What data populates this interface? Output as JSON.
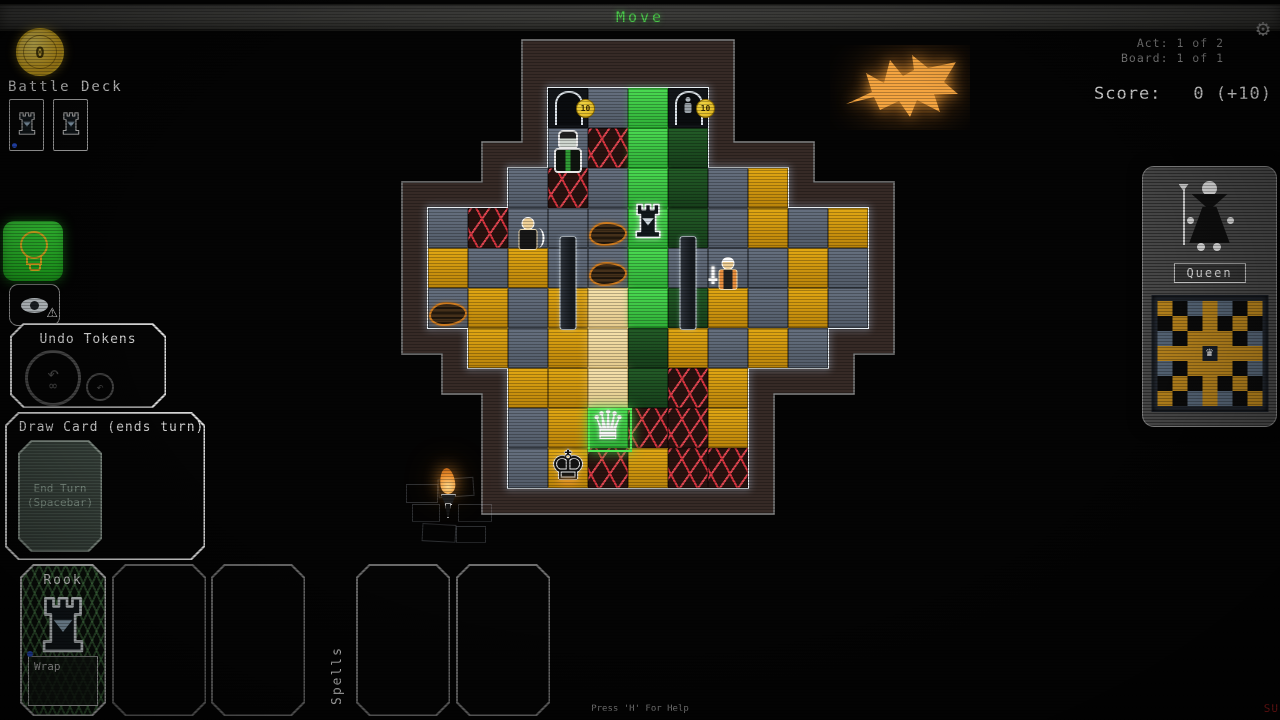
{
  "top_bar": {
    "title": "Move"
  },
  "top_right": {
    "act": "Act: 1 of 2",
    "board": "Board: 1 of 1",
    "score_label": "Score:",
    "score_value": "0 (+10)"
  },
  "left_hud": {
    "coin_value": "0",
    "battle_deck_label": "Battle Deck",
    "deck_card_count": 2
  },
  "icons": {
    "settings": "gear-icon",
    "hint": "lightbulb-icon",
    "preview": "eye-warning-icon",
    "undo_big": "undo-infinity-icon",
    "undo_small": "undo-arrow-icon",
    "coin": "gold-coin-icon",
    "undo_arrow_glyph": "↶",
    "infinity_glyph": "∞",
    "warning_glyph": "⚠",
    "gear_glyph": "⚙"
  },
  "undo_panel": {
    "title": "Undo Tokens"
  },
  "draw_panel": {
    "title": "Draw Card (ends turn)",
    "line1": "End Turn",
    "line2": "(Spacebar)"
  },
  "hand": {
    "cards": [
      {
        "name": "Rook",
        "ability": "Wrap",
        "icon": "rook-tower-icon",
        "marker_color": "#2b54d8"
      }
    ],
    "empty_slots": 2
  },
  "spells": {
    "label": "Spells",
    "empty_slots": 2
  },
  "piece_panel": {
    "name": "Queen",
    "figure": "queen-character-illustration",
    "mini_board": {
      "pattern": [
        "GKBGBKG",
        "KGKGKGK",
        "BKGGGKB",
        "GGGQGGG",
        "BKGGGKB",
        "KGKGKGK",
        "GKBGBKG"
      ],
      "colors": {
        "G": "#c28b1e",
        "B": "#5b6b7d",
        "K": "#0c0c0c",
        "Q": "#1c222b"
      },
      "center_piece": "queen"
    }
  },
  "board": {
    "door_badge": "10",
    "rows": [
      {
        "r": 0,
        "start": 3,
        "cells": "DGED"
      },
      {
        "r": 1,
        "start": 3,
        "cells": "GLEN"
      },
      {
        "r": 2,
        "start": 2,
        "cells": "GLGENGO"
      },
      {
        "r": 3,
        "start": 0,
        "cells": "GLGGGENGOGO"
      },
      {
        "r": 4,
        "start": 0,
        "cells": "OGOGGEGGGOG"
      },
      {
        "r": 5,
        "start": 0,
        "cells": "GOGOCENOGOG"
      },
      {
        "r": 6,
        "start": 1,
        "cells": "OGOCNOGOG"
      },
      {
        "r": 7,
        "start": 2,
        "cells": "OOCNLO"
      },
      {
        "r": 8,
        "start": 2,
        "cells": "GOELLO"
      },
      {
        "r": 9,
        "start": 2,
        "cells": "GOLOLL"
      }
    ],
    "selection": {
      "r": 8,
      "c": 4
    },
    "pieces": [
      {
        "type": "rook",
        "r": 3,
        "c": 5
      },
      {
        "type": "queen",
        "r": 8,
        "c": 4
      },
      {
        "type": "king",
        "r": 9,
        "c": 3
      },
      {
        "type": "imp",
        "r": 1,
        "c": 3
      },
      {
        "type": "archer",
        "r": 3,
        "c": 2
      },
      {
        "type": "swordsman",
        "r": 4,
        "c": 7
      },
      {
        "type": "pillar",
        "r": 5,
        "c": 3
      },
      {
        "type": "pillar",
        "r": 5,
        "c": 6
      },
      {
        "type": "rubble",
        "r": 3,
        "c": 4
      },
      {
        "type": "rubble",
        "r": 4,
        "c": 4
      },
      {
        "type": "rubble",
        "r": 5,
        "c": 0
      },
      {
        "type": "dweller",
        "r": 0,
        "c": 6
      }
    ],
    "decor": {
      "bat": "glowing-bat",
      "torch": "wall-torch"
    }
  },
  "footer": {
    "help": "Press 'H' For Help",
    "watermark": "SU"
  },
  "colors": {
    "accent_green": "#44c944",
    "tile_gold": "#d3960f",
    "tile_green": "#3ecb44",
    "tile_slate": "#5c6573",
    "tile_cream": "#efd9a2",
    "lava_red": "#e03844",
    "wall_brick": "#362a26",
    "glow_white": "#e6edf2",
    "bat_orange": "#f4a440"
  }
}
